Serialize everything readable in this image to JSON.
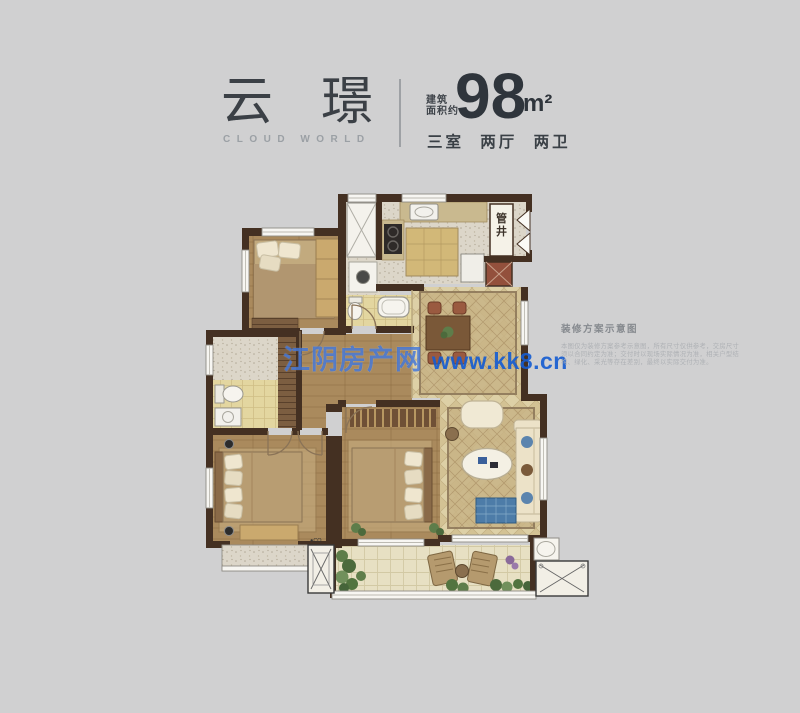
{
  "header": {
    "title": "云璟",
    "subtitle_en": "CLOUD WORLD",
    "area_label_line1": "建筑",
    "area_label_line2": "面积约",
    "area_value": "98",
    "area_unit": "m²",
    "layout_spec": "三室 两厅 两卫"
  },
  "floorplan": {
    "shaft_label": "管井",
    "ac_platform_label": "●CO"
  },
  "watermark": {
    "site_name": "江阴房产网",
    "site_url": "www.kk8.cn",
    "color": "#2a6ad2"
  },
  "side_note": {
    "title": "装修方案示意图",
    "lines": [
      "本图仅为装修方案参考示意图，所有尺寸仅供参考，交房尺寸",
      "须以合同约定为准；交付时以现场实际情况为准，相关户型结",
      "构、绿化、采光等存在差别，最终以实际交付为准。"
    ]
  },
  "colors": {
    "background": "#d0d0d1",
    "wall_brown": "#443022",
    "wood_floor": "#ab8b5e",
    "tile_beige": "#ddd0a6",
    "watermark_blue": "#2a6ad2",
    "heading_dark": "#3b4046"
  }
}
